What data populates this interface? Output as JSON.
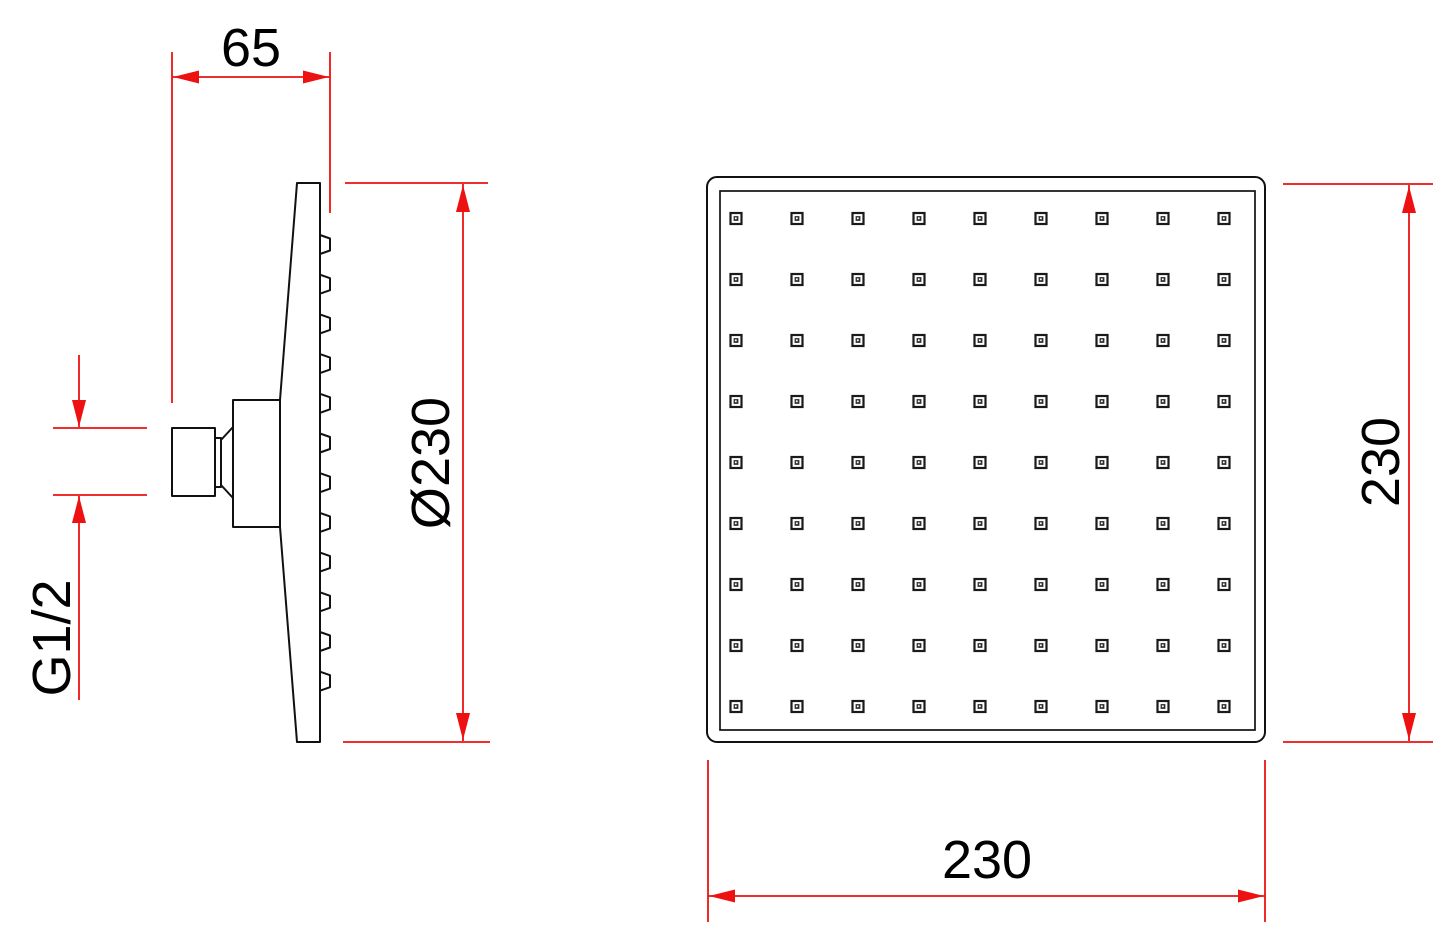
{
  "dimensions": {
    "side_depth": "65",
    "side_diameter": "Ø230",
    "thread": "G1/2",
    "front_height": "230",
    "front_width": "230"
  },
  "colors": {
    "dimension_red": "#ee1111",
    "line_black": "#111111"
  },
  "geometry": {
    "front_view": {
      "rows": 9,
      "cols": 9,
      "start_x": 736,
      "start_y": 218.5,
      "pitch_x": 61,
      "pitch_y": 61
    },
    "side_view": {
      "bump_count": 12,
      "bump_start_y": 235,
      "bump_pitch": 39.7
    }
  }
}
